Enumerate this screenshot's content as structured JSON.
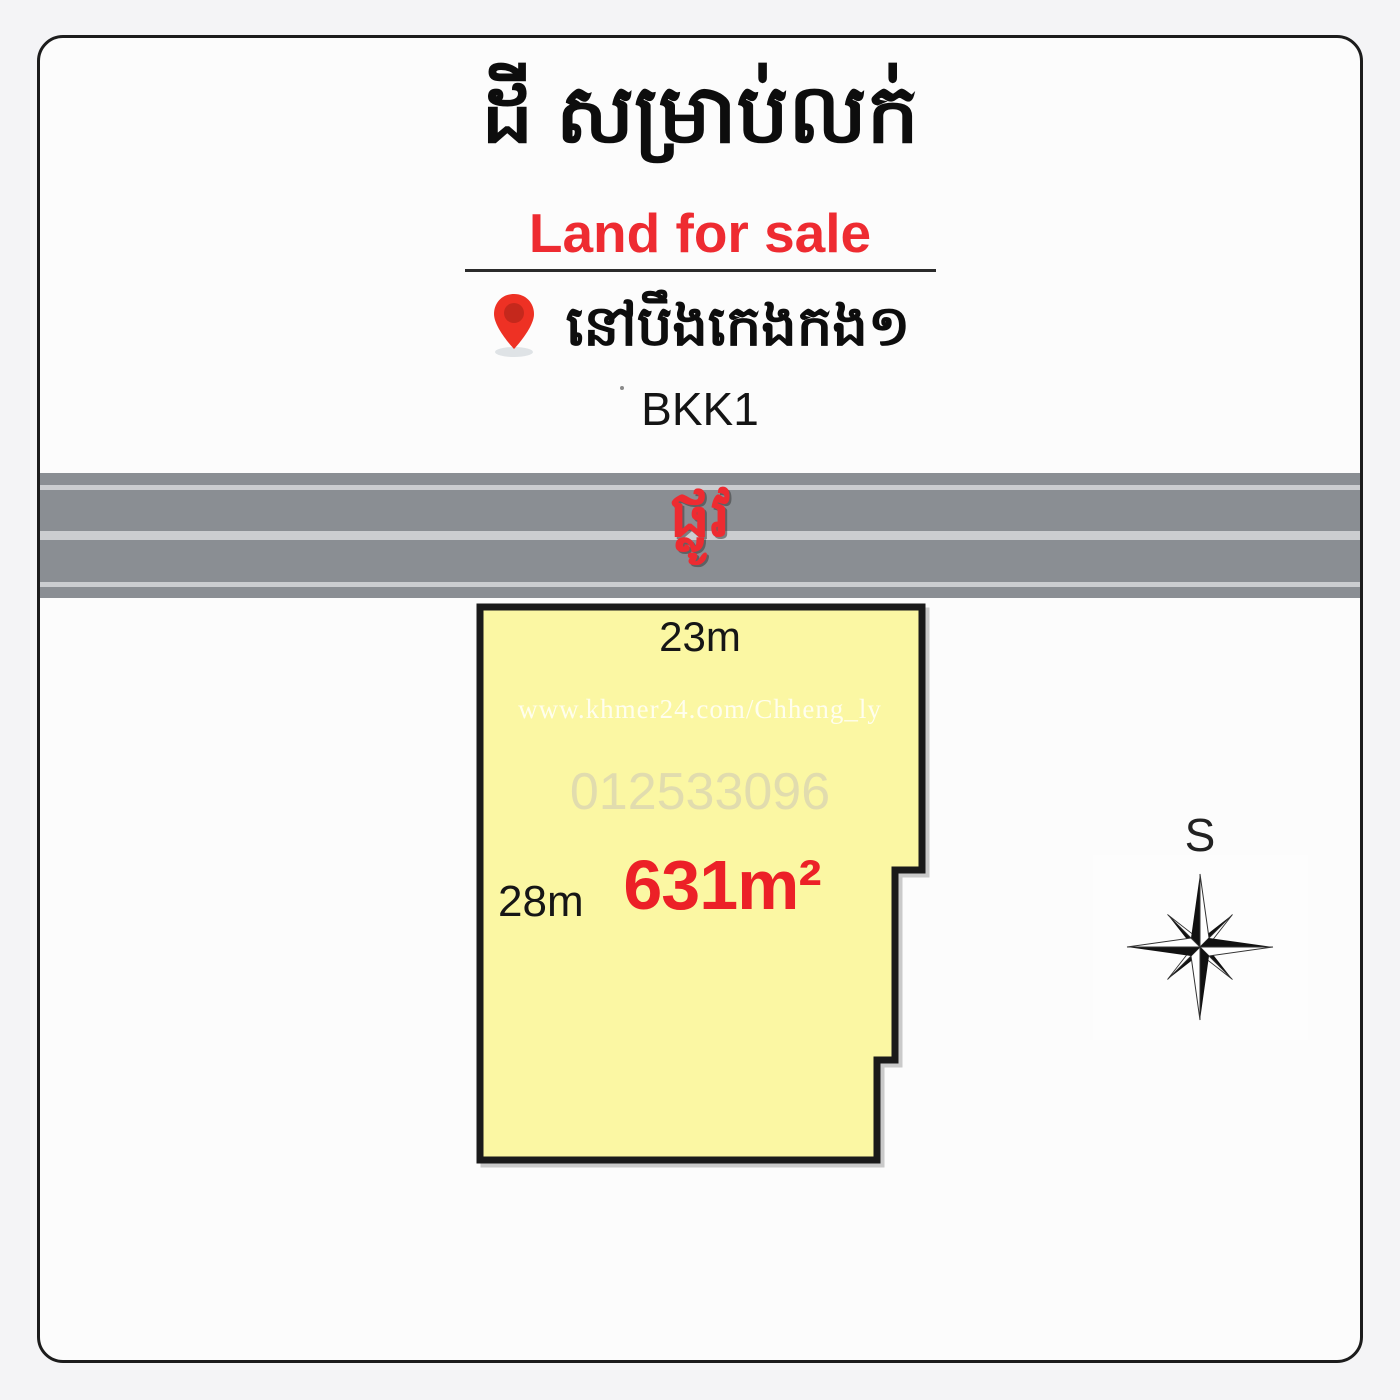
{
  "header": {
    "title_km": "ដី សម្រាប់លក់",
    "subtitle_en": "Land for sale",
    "location_km": "នៅបឹងកេងកង១",
    "location_en": "BKK1"
  },
  "road": {
    "label_km": "ផ្លូវ"
  },
  "plot": {
    "top_dimension": "23m",
    "left_dimension": "28m",
    "area": "631m²",
    "watermark_url": "www.khmer24.com/Chheng_ly",
    "watermark_phone": "012533096"
  },
  "compass": {
    "label": "S"
  },
  "colors": {
    "page-bg": "#f4f4f6",
    "card-bg": "#fcfcfc",
    "card-border": "#1c1c1c",
    "accent-red": "#ee2b31",
    "area-red": "#ec2027",
    "road-gray": "#8a8e93",
    "stripe": "#cbcdd0",
    "plot-fill": "#fbf7a3",
    "plot-outline": "#1a1a1a",
    "pin-red": "#ee3124",
    "pin-inner": "#c5281c"
  }
}
